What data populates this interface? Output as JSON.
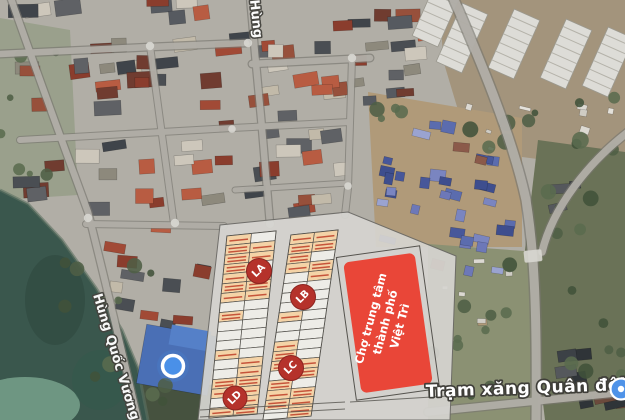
{
  "streets": {
    "hung": "Hùng",
    "hung_quoc_vuong": "Hùng Quốc Vương"
  },
  "poi": {
    "gas_station_label": "Trạm xăng Quân đội"
  },
  "market": {
    "lines": [
      "Chợ trung tâm",
      "thành phố",
      "Việt Trì"
    ]
  },
  "markers": {
    "la": "LA",
    "lb": "LB",
    "lc": "LC",
    "ld": "LD"
  },
  "colors": {
    "market_red": "#e94638",
    "marker_red": "#b5322b",
    "location_blue": "#4a90e8",
    "poi_blue": "#4f93e8",
    "plan_gray": "#d5d4d0",
    "lot_orange": "#f4d3a7"
  }
}
